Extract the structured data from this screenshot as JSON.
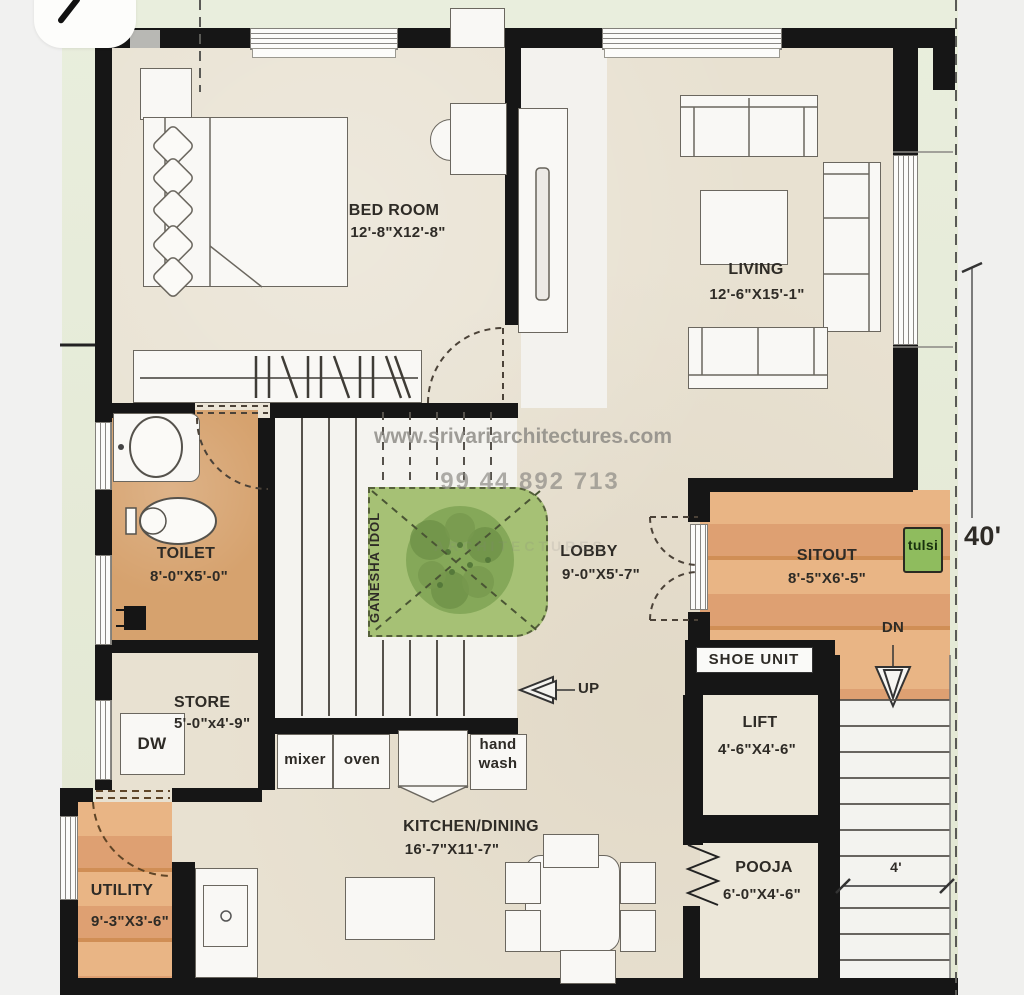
{
  "watermark": {
    "url": "www.srivariarchitectures.com",
    "phone": "99 44 892 713",
    "ghost": "ARCHITECTURES"
  },
  "rooms": {
    "bedroom": {
      "name": "BED ROOM",
      "size": "12'-8\"X12'-8\""
    },
    "living": {
      "name": "LIVING",
      "size": "12'-6\"X15'-1\""
    },
    "toilet": {
      "name": "TOILET",
      "size": "8'-0\"X5'-0\""
    },
    "lobby": {
      "name": "LOBBY",
      "size": "9'-0\"X5'-7\""
    },
    "sitout": {
      "name": "SITOUT",
      "size": "8'-5\"X6'-5\""
    },
    "store": {
      "name": "STORE",
      "size": "5'-0\"x4'-9\""
    },
    "lift": {
      "name": "LIFT",
      "size": "4'-6\"X4'-6\""
    },
    "pooja": {
      "name": "POOJA",
      "size": "6'-0\"X4'-6\""
    },
    "kitchen_dining": {
      "name": "KITCHEN/DINING",
      "size": "16'-7\"X11'-7\""
    },
    "utility": {
      "name": "UTILITY",
      "size": "9'-3\"X3'-6\""
    }
  },
  "features": {
    "ganesha_idol": "GANESHA IDOL",
    "tulsi": "tulsi",
    "shoe_unit": "SHOE UNIT",
    "dw": "DW",
    "mixer": "mixer",
    "oven": "oven",
    "hand_wash": "hand\nwash",
    "up": "UP",
    "dn": "DN"
  },
  "dimensions": {
    "plot_depth": "40'",
    "stair_width": "4'"
  },
  "colors": {
    "wall": "#161616",
    "wood_floor": "#e0a06a",
    "lawn": "#e4e9d5",
    "floor_beige": "#e8e1d1",
    "landing_green": "#a6c175",
    "tulsi_green": "#8fbc5e"
  }
}
